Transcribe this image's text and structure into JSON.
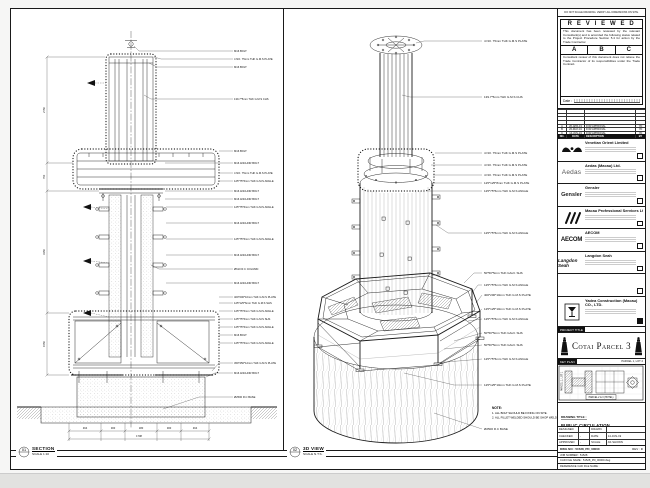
{
  "sheet": {
    "no_scale_note": "DO NOT SCALE DRAWING. VERIFY ALL DIMENSIONS ON SITE."
  },
  "section_view": {
    "view_no": "01",
    "title": "SECTION",
    "scale": "SCALE 1:10",
    "labels": [
      "M16 BOLT",
      "4 NO. 75mm THK G.M.S PLATE",
      "M16 BOLT",
      "139.7*5mm THK G.M.S CHS",
      "M16 BOLT",
      "M16 ANCHOR BOLT",
      "4 NO. 75mm THK G.M.S PLATE",
      "125*75*6mm THK G.M.S ANGLE",
      "M16 ANCHOR BOLT",
      "M16 ANCHOR BOLT",
      "125*75*6mm THK G.M.S ANGLE",
      "M16 ANCHOR BOLT",
      "125*75*6mm THK G.M.S ANGLE",
      "M16 ANCHOR BOLT",
      "Ø610 R.C COLUMN",
      "M16 ANCHOR BOLT",
      "400*200*10mm THK G.M.S PLATE",
      "125*125*6mm THK G.M.S SHS",
      "125*75*6mm THK G.M.S ANGLE",
      "125*75*6mm THK G.M.S SHS",
      "125*75*6mm THK G.M.S ANGLE",
      "M16 BOLT",
      "125*75*6mm THK G.M.S ANGLE",
      "450*450*12mm THK G.M.S PLATE",
      "M16 ANCHOR BOLT",
      "Ø2500 R.C BASE"
    ],
    "dims_bottom": [
      "464",
      "300",
      "180",
      "300",
      "464"
    ],
    "dim_total": "1708",
    "dims_left": [
      "2750",
      "750",
      "3150",
      "1550"
    ]
  },
  "iso_view": {
    "view_no": "02",
    "title": "3D VIEW",
    "scale": "SCALE N.T.S.",
    "labels": [
      "4 NO. 75mm THK G.M.S PLATE",
      "139.7*5mm THK G.M.S CHS",
      "4 NO. 75mm THK G.M.S PLATE",
      "4 NO. 75mm THK G.M.S PLATE",
      "4 NO. 75mm THK G.M.S PLATE",
      "125*125*8mm THK G.M.S PLATE",
      "125*75*6mm THK G.M.S ANGLE",
      "125*75*6mm THK G.M.S ANGLE",
      "50*50*5mm THK GALV. SHS",
      "125*75*6mm THK G.M.S ANGLE",
      "400*200*10mm THK G.M.S PLATE",
      "125*125*10mm THK G.M.S PLATE",
      "125*75*6mm THK G.M.S ANGLE",
      "50*50*5mm THK GALV. SHS",
      "50*50*5mm THK GALV. SHS",
      "125*75*6mm THK G.M.S ANGLE",
      "125*125*10mm THK G.M.S PLATE",
      "Ø2500 R.C BASE"
    ],
    "note_title": "NOTE:",
    "note_lines": [
      "1. ALL BOLT SHOULD BE FIXING ON SITE.",
      "2. ALL FILLET WELDED SHOULD BE SHOP WELD."
    ]
  },
  "titleblock": {
    "reviewed": {
      "title": "R E V I E W E D",
      "body1": "This document has been reviewed by the relevant Consultant(s) and is accorded the following status related to the Project Procedure Section 5.4 for action by the Trade Contractor.",
      "options": [
        "A",
        "B",
        "C"
      ],
      "body2": "Consultant review of this document does not relieve the Trade Contractor of its responsibilities under the Trade Contract.",
      "date_label": "Date :"
    },
    "revisions": {
      "headers": [
        "NO.",
        "DATE",
        "DESCRIPTION",
        "BY"
      ],
      "rows": [
        {
          "no": "A",
          "date": "26-APR-19",
          "desc": "FOR APPROVAL",
          "by": "YD"
        },
        {
          "no": "B",
          "date": "20-MAY-19",
          "desc": "FOR APPROVAL",
          "by": "YD"
        },
        {
          "no": "C",
          "date": "14-JUN-19",
          "desc": "FOR APPROVAL",
          "by": "YD"
        }
      ]
    },
    "companies": [
      {
        "name": "Venetian Orient Limited",
        "logo_text": ""
      },
      {
        "name": "Aedas (Macau) Ltd.",
        "logo_text": "Aedas"
      },
      {
        "name": "Gensler",
        "logo_text": "Gensler"
      },
      {
        "name": "Macau Professional Services Ltd.",
        "logo_text": ""
      },
      {
        "name": "AECOM",
        "logo_text": "AECOM"
      },
      {
        "name": "Langdon Seah",
        "logo_text": "Langdon Seah"
      },
      {
        "name": "",
        "logo_text": ""
      }
    ],
    "contractor": {
      "name": "Yadea Construction (Macau) CO., LTD."
    },
    "project_title_label": "PROJECT TITLE",
    "project_title": "Cotai Parcel 3",
    "key_plan": {
      "label": "KEY PLAN",
      "top_right": "PARCEL 1, LOT 2",
      "left": "PARCEL 1, LOT 1",
      "bottom": "PARCEL 2 & 3 (HOTEL)"
    },
    "drawing_title_label": "DRAWING TITLE :",
    "drawing_title_lines": [
      "PUBLIC CIRCULATION",
      "FOUNTAIN DETAIL IN",
      "POR STEEL DRAWING"
    ],
    "info": {
      "rows": [
        [
          "DESIGNED",
          "",
          "DRAWN",
          ""
        ],
        [
          "CHECKED",
          "-",
          "DATE",
          "14-JUN-19"
        ],
        [
          "APPROVED",
          "-",
          "SCALE",
          "AS SHOWN"
        ]
      ]
    },
    "doc": {
      "dwg_label": "DWG NO :",
      "dwg_no": "51528_PD_00000",
      "rev_label": "REV :",
      "rev": "C",
      "job_label": "JOB NUMBER :",
      "job_no": "51528",
      "cad_label": "CAD FILE NAME :",
      "cad_file": "51528_PD_00000.dwg",
      "ref_label": "REFERENCE CAD FILE NAME :"
    }
  }
}
